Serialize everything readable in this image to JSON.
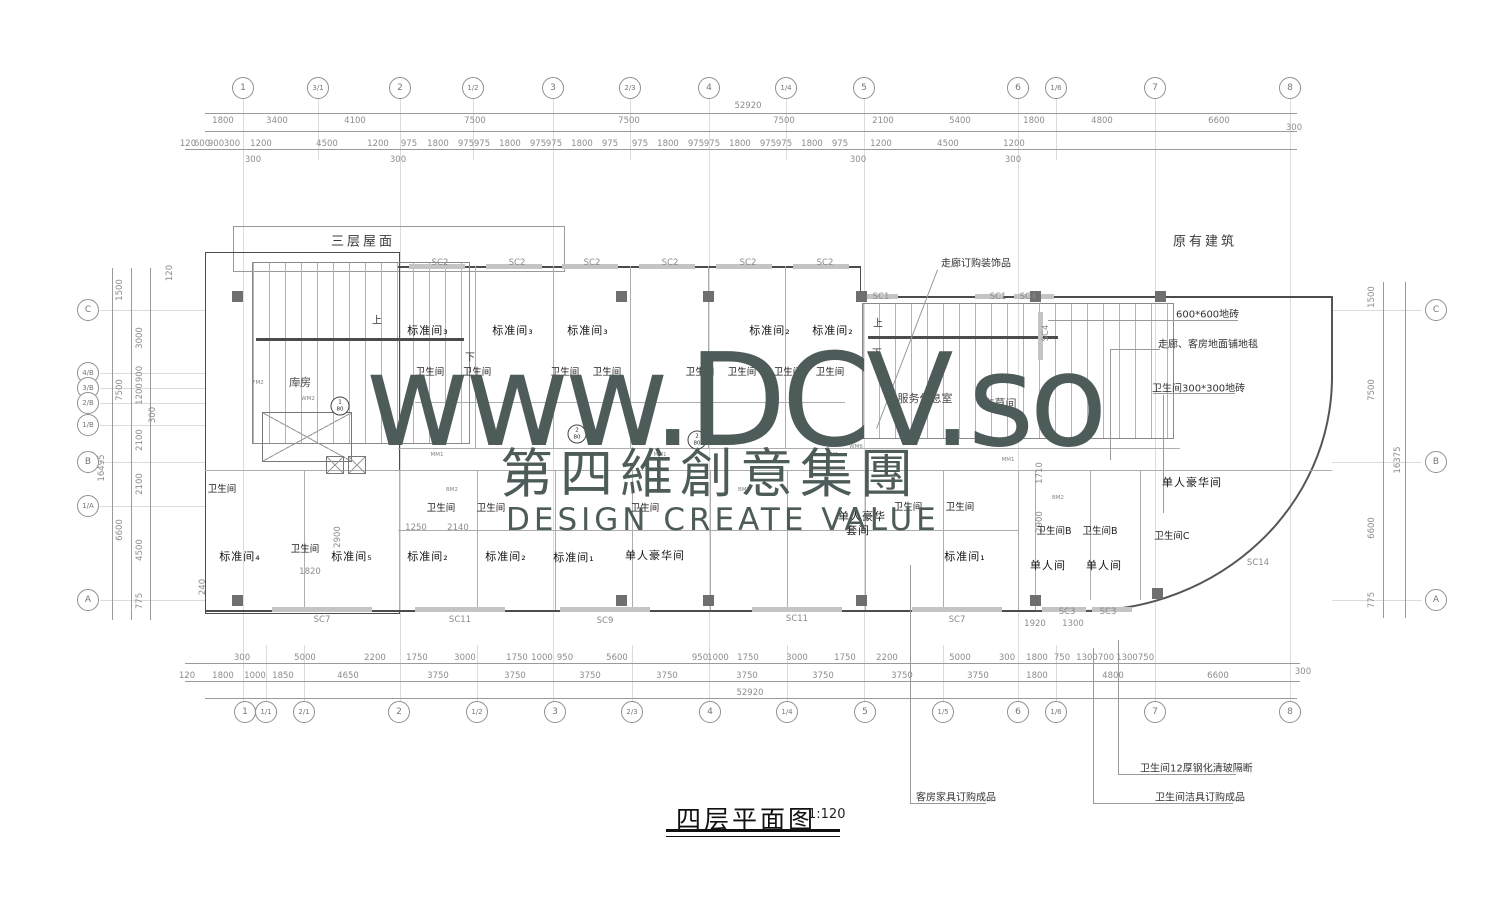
{
  "watermark": {
    "line1": "www.DCV.so",
    "line2": "第四維創意集團",
    "line3": "DESIGN CREATE VALUE",
    "color": "#4d5b59"
  },
  "title": {
    "text": "四层平面图",
    "scale": "1:120"
  },
  "grid": {
    "top": [
      {
        "t": "1",
        "x": 243,
        "y": 88
      },
      {
        "t": "3/1",
        "x": 318,
        "y": 88,
        "cls": "s"
      },
      {
        "t": "2",
        "x": 400,
        "y": 88
      },
      {
        "t": "1/2",
        "x": 473,
        "y": 88,
        "cls": "s"
      },
      {
        "t": "3",
        "x": 553,
        "y": 88
      },
      {
        "t": "2/3",
        "x": 630,
        "y": 88,
        "cls": "s"
      },
      {
        "t": "4",
        "x": 709,
        "y": 88
      },
      {
        "t": "1/4",
        "x": 786,
        "y": 88,
        "cls": "s"
      },
      {
        "t": "5",
        "x": 864,
        "y": 88
      },
      {
        "t": "6",
        "x": 1018,
        "y": 88
      },
      {
        "t": "1/6",
        "x": 1056,
        "y": 88,
        "cls": "s"
      },
      {
        "t": "7",
        "x": 1155,
        "y": 88
      },
      {
        "t": "8",
        "x": 1290,
        "y": 88
      }
    ],
    "bottom": [
      {
        "t": "1",
        "x": 245,
        "y": 712
      },
      {
        "t": "1/1",
        "x": 266,
        "y": 712,
        "cls": "s"
      },
      {
        "t": "2/1",
        "x": 304,
        "y": 712,
        "cls": "s"
      },
      {
        "t": "2",
        "x": 399,
        "y": 712
      },
      {
        "t": "1/2",
        "x": 477,
        "y": 712,
        "cls": "s"
      },
      {
        "t": "3",
        "x": 555,
        "y": 712
      },
      {
        "t": "2/3",
        "x": 632,
        "y": 712,
        "cls": "s"
      },
      {
        "t": "4",
        "x": 710,
        "y": 712
      },
      {
        "t": "1/4",
        "x": 787,
        "y": 712,
        "cls": "s"
      },
      {
        "t": "5",
        "x": 865,
        "y": 712
      },
      {
        "t": "1/5",
        "x": 943,
        "y": 712,
        "cls": "s"
      },
      {
        "t": "6",
        "x": 1018,
        "y": 712
      },
      {
        "t": "1/6",
        "x": 1056,
        "y": 712,
        "cls": "s"
      },
      {
        "t": "7",
        "x": 1155,
        "y": 712
      },
      {
        "t": "8",
        "x": 1290,
        "y": 712
      }
    ],
    "left": [
      {
        "t": "C",
        "x": 88,
        "y": 310
      },
      {
        "t": "4/B",
        "x": 88,
        "y": 373,
        "cls": "s"
      },
      {
        "t": "3/B",
        "x": 88,
        "y": 388,
        "cls": "s"
      },
      {
        "t": "2/B",
        "x": 88,
        "y": 403,
        "cls": "s"
      },
      {
        "t": "1/B",
        "x": 88,
        "y": 425,
        "cls": "s"
      },
      {
        "t": "B",
        "x": 88,
        "y": 462
      },
      {
        "t": "1/A",
        "x": 88,
        "y": 506,
        "cls": "s"
      },
      {
        "t": "A",
        "x": 88,
        "y": 600
      }
    ],
    "right": [
      {
        "t": "C",
        "x": 1436,
        "y": 310
      },
      {
        "t": "B",
        "x": 1436,
        "y": 462
      },
      {
        "t": "A",
        "x": 1436,
        "y": 600
      }
    ]
  },
  "dims": {
    "top_total": [
      {
        "t": "52920",
        "x": 748,
        "y": 106
      }
    ],
    "top_row1": [
      {
        "t": "1800",
        "x": 223,
        "y": 121
      },
      {
        "t": "3400",
        "x": 277,
        "y": 121
      },
      {
        "t": "4100",
        "x": 355,
        "y": 121
      },
      {
        "t": "7500",
        "x": 475,
        "y": 121
      },
      {
        "t": "7500",
        "x": 629,
        "y": 121
      },
      {
        "t": "7500",
        "x": 784,
        "y": 121
      },
      {
        "t": "2100",
        "x": 883,
        "y": 121
      },
      {
        "t": "5400",
        "x": 960,
        "y": 121
      },
      {
        "t": "1800",
        "x": 1034,
        "y": 121
      },
      {
        "t": "4800",
        "x": 1102,
        "y": 121
      },
      {
        "t": "6600",
        "x": 1219,
        "y": 121
      },
      {
        "t": "300",
        "x": 1294,
        "y": 128
      }
    ],
    "top_row2": [
      {
        "t": "120",
        "x": 188,
        "y": 144
      },
      {
        "t": "600",
        "x": 202,
        "y": 144
      },
      {
        "t": "900",
        "x": 216,
        "y": 144
      },
      {
        "t": "300",
        "x": 232,
        "y": 144
      },
      {
        "t": "1200",
        "x": 261,
        "y": 144
      },
      {
        "t": "4500",
        "x": 327,
        "y": 144
      },
      {
        "t": "1200",
        "x": 378,
        "y": 144
      },
      {
        "t": "975",
        "x": 409,
        "y": 144
      },
      {
        "t": "1800",
        "x": 438,
        "y": 144
      },
      {
        "t": "975",
        "x": 466,
        "y": 144
      },
      {
        "t": "975",
        "x": 482,
        "y": 144
      },
      {
        "t": "1800",
        "x": 510,
        "y": 144
      },
      {
        "t": "975",
        "x": 538,
        "y": 144
      },
      {
        "t": "975",
        "x": 554,
        "y": 144
      },
      {
        "t": "1800",
        "x": 582,
        "y": 144
      },
      {
        "t": "975",
        "x": 610,
        "y": 144
      },
      {
        "t": "975",
        "x": 640,
        "y": 144
      },
      {
        "t": "1800",
        "x": 668,
        "y": 144
      },
      {
        "t": "975",
        "x": 696,
        "y": 144
      },
      {
        "t": "975",
        "x": 712,
        "y": 144
      },
      {
        "t": "1800",
        "x": 740,
        "y": 144
      },
      {
        "t": "975",
        "x": 768,
        "y": 144
      },
      {
        "t": "975",
        "x": 784,
        "y": 144
      },
      {
        "t": "1800",
        "x": 812,
        "y": 144
      },
      {
        "t": "975",
        "x": 840,
        "y": 144
      },
      {
        "t": "1200",
        "x": 881,
        "y": 144
      },
      {
        "t": "4500",
        "x": 948,
        "y": 144
      },
      {
        "t": "1200",
        "x": 1014,
        "y": 144
      }
    ],
    "top_small": [
      {
        "t": "300",
        "x": 253,
        "y": 160
      },
      {
        "t": "300",
        "x": 398,
        "y": 160
      },
      {
        "t": "300",
        "x": 858,
        "y": 160
      },
      {
        "t": "300",
        "x": 1013,
        "y": 160
      }
    ],
    "bottom_row1": [
      {
        "t": "300",
        "x": 242,
        "y": 658
      },
      {
        "t": "5000",
        "x": 305,
        "y": 658
      },
      {
        "t": "2200",
        "x": 375,
        "y": 658
      },
      {
        "t": "1750",
        "x": 417,
        "y": 658
      },
      {
        "t": "3000",
        "x": 465,
        "y": 658
      },
      {
        "t": "1750",
        "x": 517,
        "y": 658
      },
      {
        "t": "1000",
        "x": 542,
        "y": 658
      },
      {
        "t": "950",
        "x": 565,
        "y": 658
      },
      {
        "t": "5600",
        "x": 617,
        "y": 658
      },
      {
        "t": "950",
        "x": 700,
        "y": 658
      },
      {
        "t": "1000",
        "x": 718,
        "y": 658
      },
      {
        "t": "1750",
        "x": 748,
        "y": 658
      },
      {
        "t": "3000",
        "x": 797,
        "y": 658
      },
      {
        "t": "1750",
        "x": 845,
        "y": 658
      },
      {
        "t": "2200",
        "x": 887,
        "y": 658
      },
      {
        "t": "5000",
        "x": 960,
        "y": 658
      },
      {
        "t": "300",
        "x": 1007,
        "y": 658
      },
      {
        "t": "1800",
        "x": 1037,
        "y": 658
      },
      {
        "t": "750",
        "x": 1062,
        "y": 658
      },
      {
        "t": "1300",
        "x": 1087,
        "y": 658
      },
      {
        "t": "700",
        "x": 1106,
        "y": 658
      },
      {
        "t": "1300",
        "x": 1127,
        "y": 658
      },
      {
        "t": "750",
        "x": 1146,
        "y": 658
      }
    ],
    "bottom_row2": [
      {
        "t": "120",
        "x": 187,
        "y": 676
      },
      {
        "t": "1800",
        "x": 223,
        "y": 676
      },
      {
        "t": "1000",
        "x": 255,
        "y": 676
      },
      {
        "t": "1850",
        "x": 283,
        "y": 676
      },
      {
        "t": "4650",
        "x": 348,
        "y": 676
      },
      {
        "t": "3750",
        "x": 438,
        "y": 676
      },
      {
        "t": "3750",
        "x": 515,
        "y": 676
      },
      {
        "t": "3750",
        "x": 590,
        "y": 676
      },
      {
        "t": "3750",
        "x": 667,
        "y": 676
      },
      {
        "t": "3750",
        "x": 747,
        "y": 676
      },
      {
        "t": "3750",
        "x": 823,
        "y": 676
      },
      {
        "t": "3750",
        "x": 902,
        "y": 676
      },
      {
        "t": "3750",
        "x": 978,
        "y": 676
      },
      {
        "t": "1800",
        "x": 1037,
        "y": 676
      },
      {
        "t": "4800",
        "x": 1113,
        "y": 676
      },
      {
        "t": "6600",
        "x": 1218,
        "y": 676
      },
      {
        "t": "300",
        "x": 1303,
        "y": 672
      }
    ],
    "bottom_total": [
      {
        "t": "52920",
        "x": 750,
        "y": 693
      }
    ],
    "left": [
      {
        "t": "1500",
        "x": 120,
        "y": 290,
        "cls": "v"
      },
      {
        "t": "7500",
        "x": 120,
        "y": 390,
        "cls": "v"
      },
      {
        "t": "6600",
        "x": 120,
        "y": 530,
        "cls": "v"
      },
      {
        "t": "16495",
        "x": 102,
        "y": 468,
        "cls": "v"
      },
      {
        "t": "120",
        "x": 170,
        "y": 273,
        "cls": "v"
      },
      {
        "t": "3000",
        "x": 140,
        "y": 338,
        "cls": "v"
      },
      {
        "t": "900",
        "x": 140,
        "y": 374,
        "cls": "v"
      },
      {
        "t": "1200",
        "x": 140,
        "y": 394,
        "cls": "v"
      },
      {
        "t": "300",
        "x": 153,
        "y": 415,
        "cls": "v"
      },
      {
        "t": "2100",
        "x": 140,
        "y": 440,
        "cls": "v"
      },
      {
        "t": "2100",
        "x": 140,
        "y": 484,
        "cls": "v"
      },
      {
        "t": "4500",
        "x": 140,
        "y": 550,
        "cls": "v"
      },
      {
        "t": "775",
        "x": 140,
        "y": 601,
        "cls": "v"
      }
    ],
    "right": [
      {
        "t": "1500",
        "x": 1372,
        "y": 297,
        "cls": "v"
      },
      {
        "t": "7500",
        "x": 1372,
        "y": 390,
        "cls": "v"
      },
      {
        "t": "16375",
        "x": 1398,
        "y": 460,
        "cls": "v"
      },
      {
        "t": "6600",
        "x": 1372,
        "y": 528,
        "cls": "v"
      },
      {
        "t": "775",
        "x": 1372,
        "y": 600,
        "cls": "v"
      }
    ],
    "inner": [
      {
        "t": "1250",
        "x": 416,
        "y": 528
      },
      {
        "t": "2140",
        "x": 458,
        "y": 528
      },
      {
        "t": "1820",
        "x": 310,
        "y": 572
      },
      {
        "t": "2900",
        "x": 338,
        "y": 537,
        "cls": "v"
      },
      {
        "t": "240",
        "x": 203,
        "y": 587,
        "cls": "v"
      },
      {
        "t": "550",
        "x": 1010,
        "y": 442
      },
      {
        "t": "1710",
        "x": 1040,
        "y": 473,
        "cls": "v"
      },
      {
        "t": "2900",
        "x": 1040,
        "y": 522,
        "cls": "v"
      },
      {
        "t": "1920",
        "x": 1035,
        "y": 624
      },
      {
        "t": "1300",
        "x": 1073,
        "y": 624
      }
    ]
  },
  "plan": {
    "areas": [
      {
        "t": "三层屋面",
        "x": 363,
        "y": 240,
        "cls": "big"
      },
      {
        "t": "原有建筑",
        "x": 1205,
        "y": 240,
        "cls": "big"
      },
      {
        "t": "库房",
        "x": 300,
        "y": 382
      },
      {
        "t": "服务休息室",
        "x": 925,
        "y": 398
      },
      {
        "t": "布草间",
        "x": 1000,
        "y": 403
      }
    ],
    "rooms": [
      {
        "t": "标准间₃",
        "x": 428,
        "y": 330
      },
      {
        "t": "标准间₃",
        "x": 513,
        "y": 330
      },
      {
        "t": "标准间₃",
        "x": 588,
        "y": 330
      },
      {
        "t": "标准间₂",
        "x": 770,
        "y": 330
      },
      {
        "t": "标准间₂",
        "x": 833,
        "y": 330
      },
      {
        "t": "标准间₄",
        "x": 240,
        "y": 556
      },
      {
        "t": "标准间₅",
        "x": 352,
        "y": 556
      },
      {
        "t": "标准间₂",
        "x": 428,
        "y": 556
      },
      {
        "t": "标准间₂",
        "x": 506,
        "y": 556
      },
      {
        "t": "标准间₁",
        "x": 574,
        "y": 557
      },
      {
        "t": "单人豪华间",
        "x": 655,
        "y": 555
      },
      {
        "t": "单人豪华",
        "x": 862,
        "y": 516
      },
      {
        "t": "套间",
        "x": 858,
        "y": 530
      },
      {
        "t": "标准间₁",
        "x": 965,
        "y": 556
      },
      {
        "t": "单人间",
        "x": 1048,
        "y": 565
      },
      {
        "t": "单人间",
        "x": 1104,
        "y": 565
      },
      {
        "t": "单人豪华间",
        "x": 1192,
        "y": 482
      }
    ],
    "baths": [
      {
        "t": "卫生间",
        "x": 430,
        "y": 371
      },
      {
        "t": "卫生间",
        "x": 477,
        "y": 371
      },
      {
        "t": "卫生间",
        "x": 565,
        "y": 371
      },
      {
        "t": "卫生间",
        "x": 607,
        "y": 371
      },
      {
        "t": "卫生间",
        "x": 700,
        "y": 371
      },
      {
        "t": "卫生间",
        "x": 742,
        "y": 371
      },
      {
        "t": "卫生间",
        "x": 788,
        "y": 371
      },
      {
        "t": "卫生间",
        "x": 830,
        "y": 371
      },
      {
        "t": "卫生间",
        "x": 222,
        "y": 488
      },
      {
        "t": "卫生间",
        "x": 305,
        "y": 548
      },
      {
        "t": "卫生间",
        "x": 441,
        "y": 507
      },
      {
        "t": "卫生间",
        "x": 491,
        "y": 507
      },
      {
        "t": "卫生间",
        "x": 645,
        "y": 507
      },
      {
        "t": "卫生间",
        "x": 908,
        "y": 506
      },
      {
        "t": "卫生间",
        "x": 960,
        "y": 506
      },
      {
        "t": "卫生间B",
        "x": 1054,
        "y": 530
      },
      {
        "t": "卫生间B",
        "x": 1100,
        "y": 530
      },
      {
        "t": "卫生间C",
        "x": 1172,
        "y": 535
      }
    ],
    "windows": [
      {
        "t": "SC2",
        "x": 440,
        "y": 263
      },
      {
        "t": "SC2",
        "x": 517,
        "y": 263
      },
      {
        "t": "SC2",
        "x": 592,
        "y": 263
      },
      {
        "t": "SC2",
        "x": 670,
        "y": 263
      },
      {
        "t": "SC2",
        "x": 748,
        "y": 263
      },
      {
        "t": "SC2",
        "x": 825,
        "y": 263
      },
      {
        "t": "SC1",
        "x": 881,
        "y": 297
      },
      {
        "t": "SC1",
        "x": 998,
        "y": 297
      },
      {
        "t": "SC4",
        "x": 1028,
        "y": 297
      },
      {
        "t": "SC4",
        "x": 1046,
        "y": 333,
        "cls": "v"
      },
      {
        "t": "SC7",
        "x": 322,
        "y": 620
      },
      {
        "t": "SC11",
        "x": 460,
        "y": 620
      },
      {
        "t": "SC9",
        "x": 605,
        "y": 621
      },
      {
        "t": "SC11",
        "x": 797,
        "y": 619
      },
      {
        "t": "SC7",
        "x": 957,
        "y": 620
      },
      {
        "t": "SC3",
        "x": 1067,
        "y": 612
      },
      {
        "t": "SC3",
        "x": 1108,
        "y": 612
      },
      {
        "t": "SC14",
        "x": 1258,
        "y": 563
      }
    ],
    "doors": [
      {
        "t": "FM2",
        "x": 258,
        "y": 383
      },
      {
        "t": "FM2",
        "x": 298,
        "y": 383
      },
      {
        "t": "WM2",
        "x": 308,
        "y": 399
      },
      {
        "t": "MM1",
        "x": 437,
        "y": 455
      },
      {
        "t": "MM1",
        "x": 660,
        "y": 455
      },
      {
        "t": "MM1",
        "x": 832,
        "y": 455
      },
      {
        "t": "MM1",
        "x": 1008,
        "y": 460
      },
      {
        "t": "BM2",
        "x": 452,
        "y": 490
      },
      {
        "t": "BM2",
        "x": 598,
        "y": 490
      },
      {
        "t": "BM2",
        "x": 744,
        "y": 490
      },
      {
        "t": "BM2",
        "x": 1058,
        "y": 498
      },
      {
        "t": "WM6",
        "x": 856,
        "y": 447
      }
    ],
    "stairs": [
      {
        "t": "上",
        "x": 377,
        "y": 319
      },
      {
        "t": "下",
        "x": 470,
        "y": 356
      },
      {
        "t": "上",
        "x": 878,
        "y": 322
      },
      {
        "t": "下",
        "x": 877,
        "y": 352
      }
    ],
    "markers": [
      {
        "t": "1\n80",
        "x": 340,
        "y": 406
      },
      {
        "t": "2\n80",
        "x": 577,
        "y": 434
      },
      {
        "t": "2\n80",
        "x": 697,
        "y": 440
      }
    ],
    "notes": [
      {
        "t": "600*600地砖",
        "x": 1176,
        "y": 313
      },
      {
        "t": "走廊、客房地面铺地毯",
        "x": 1158,
        "y": 343
      },
      {
        "t": "卫生间300*300地砖",
        "x": 1152,
        "y": 387
      },
      {
        "t": "走廊订购装饰品",
        "x": 941,
        "y": 262
      },
      {
        "t": "客房家具订购成品",
        "x": 916,
        "y": 796
      },
      {
        "t": "卫生间12厚钢化清玻隔断",
        "x": 1140,
        "y": 767
      },
      {
        "t": "卫生间洁具订购成品",
        "x": 1155,
        "y": 796
      }
    ]
  }
}
